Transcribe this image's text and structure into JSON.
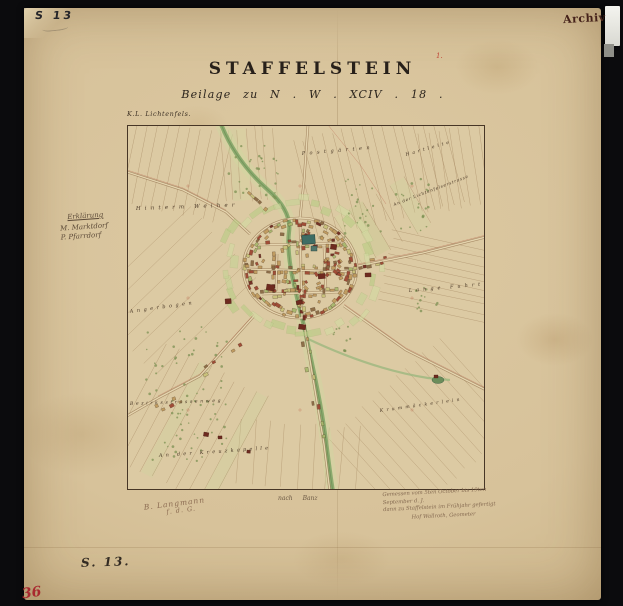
{
  "stamps": {
    "top_left": "S 13",
    "archiv": "Archiv",
    "red_mark": "1."
  },
  "title": {
    "main": "STAFFELSTEIN",
    "subtitle": "Beilage zu N . W . XCIV . 18 ."
  },
  "notes": {
    "map_source": "K.L. Lichtenfels.",
    "legend_title": "Erklärung",
    "legend_items": [
      "M. Marktdorf",
      "P. Pfarrdorf"
    ],
    "below_map": "nach Banz",
    "surveyor_lines": [
      "Gemessen vom 5ten October bis 19ten September d. J.",
      "dann zu Staffelstein im Frühjahr gefertigt",
      "Hof Wallroth, Geometer"
    ],
    "left_note": "B. Langmann",
    "left_note2": "f. d. G.",
    "sheet_number": "S. 13.",
    "page_number": "36"
  },
  "map": {
    "labels": [
      {
        "text": "Hinterm Weiher"
      },
      {
        "text": "Postgärten"
      },
      {
        "text": "Hartleite"
      },
      {
        "text": "An der Lichtenfelserstrasse"
      },
      {
        "text": "Lange Fuhrt"
      },
      {
        "text": "Angerbogen"
      },
      {
        "text": "Bezirksstrassenweg"
      },
      {
        "text": "Krummäckerlein"
      },
      {
        "text": "An der Kreuzkapelle"
      }
    ],
    "colors": {
      "paper": "#d7c29a",
      "building_tan": "#bf9a5e",
      "building_red": "#9d4732",
      "building_darkred": "#6f2a20",
      "garden_green": "#c6d395",
      "stream_green": "#84a668",
      "church_teal": "#3e6d64",
      "survey_red": "#b04a36",
      "stamp_red": "#a8292f"
    }
  }
}
